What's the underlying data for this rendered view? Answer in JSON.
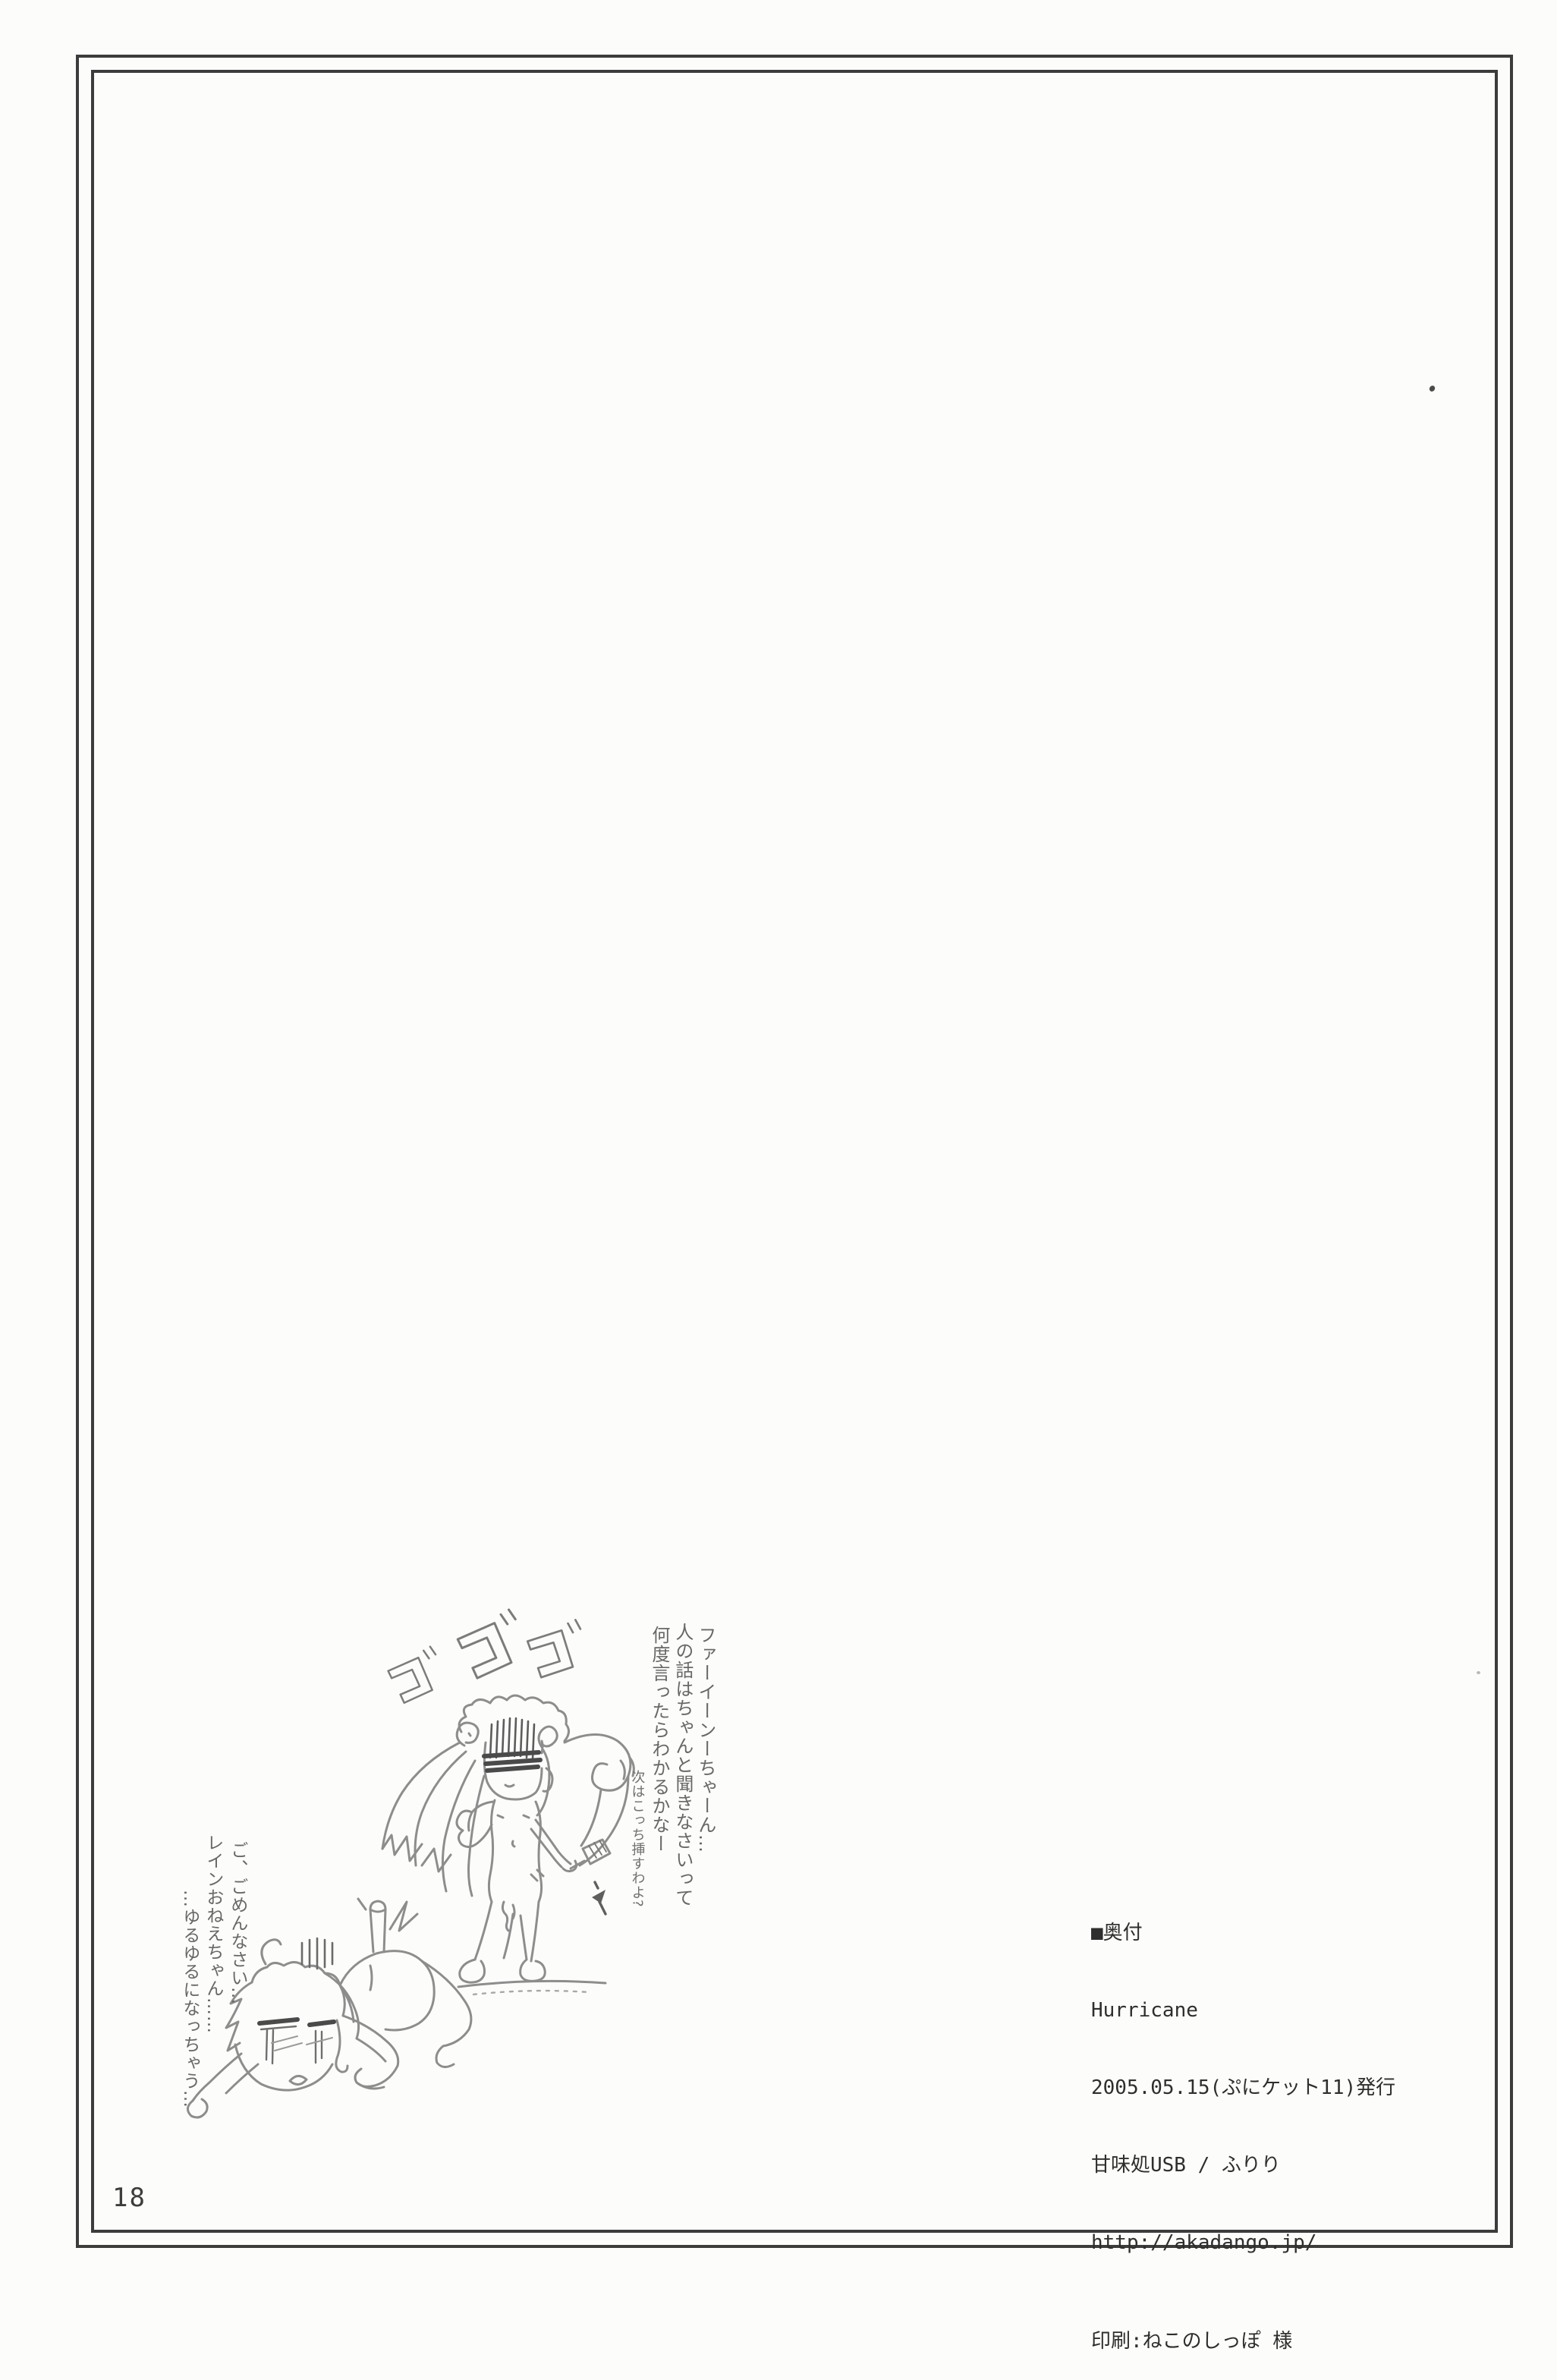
{
  "page": {
    "number": "18"
  },
  "colors": {
    "paper": "#fcfcfa",
    "border": "#3c3c3c",
    "colophon_ink": "#2e2e2e",
    "pencil": "#8d8d8d",
    "pencil_dark": "#4a4a4a"
  },
  "colophon": {
    "heading": "■奥付",
    "title": "Hurricane",
    "published": "2005.05.15(ぷにケット11)発行",
    "circle": "甘味処USB / ふりり",
    "url": "http://akadango.jp/",
    "printer": "印刷:ねこのしっぽ 様"
  },
  "sketch": {
    "sfx": "ゴゴゴ",
    "scold_lines": [
      "ファーイーンーちゃーん…",
      "人の話はちゃんと聞きなさいって",
      "何度言ったらわかるかなー"
    ],
    "scold_small": "次はこっち挿すわよ?",
    "apology_lines": [
      "ご、ごめんなさい…",
      "レインおねえちゃん……",
      "…ゆるゆるになっちゃう…"
    ]
  }
}
